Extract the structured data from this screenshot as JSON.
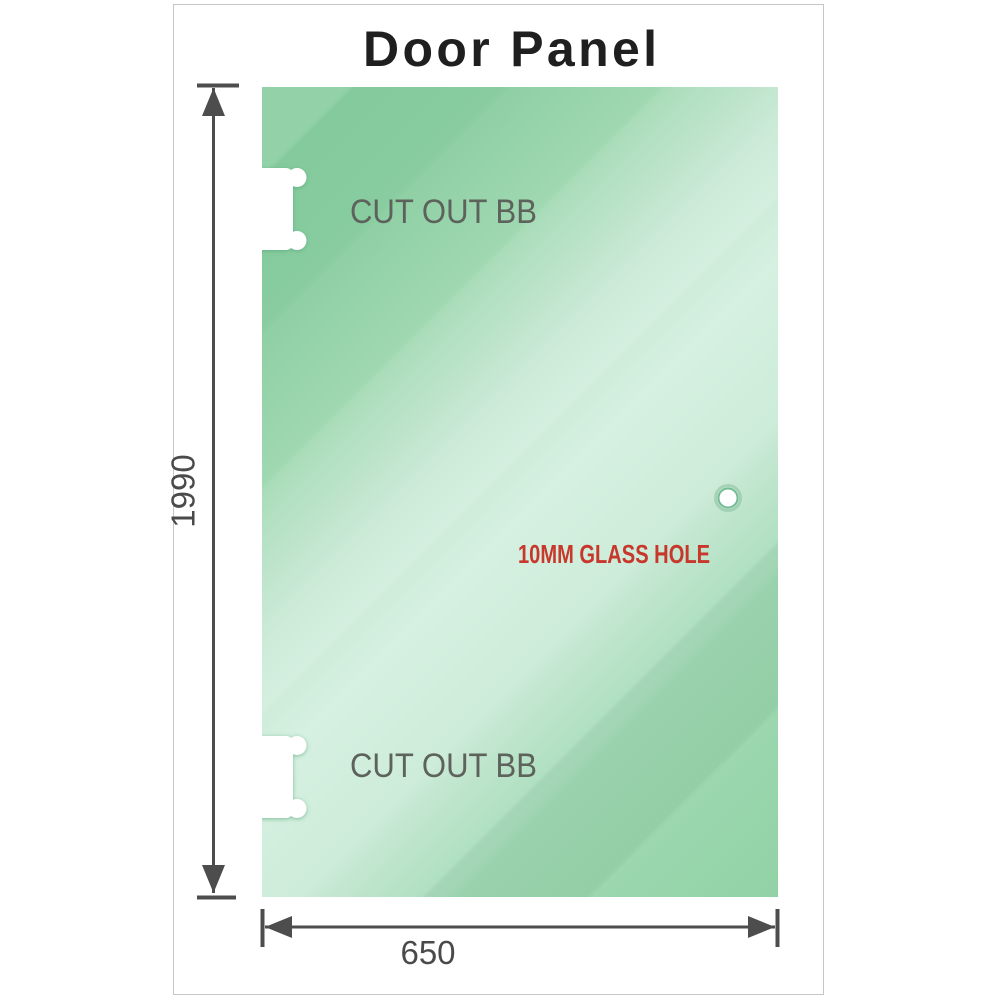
{
  "title": "Door Panel",
  "panel": {
    "cutout_top_label": "CUT OUT BB",
    "cutout_bottom_label": "CUT OUT BB",
    "hole_label": "10MM GLASS HOLE"
  },
  "dimensions": {
    "height_label": "1990",
    "width_label": "650"
  },
  "colors": {
    "glass_green": "#87cc9f",
    "glass_green_pale": "#d6f0e1",
    "dimension_gray": "#4d4d4d",
    "cutout_label_gray": "#5e625c",
    "hole_label_red": "#c8372b",
    "title_color": "#1f1f1f",
    "frame_border": "#c6c6c6",
    "background": "#ffffff"
  }
}
